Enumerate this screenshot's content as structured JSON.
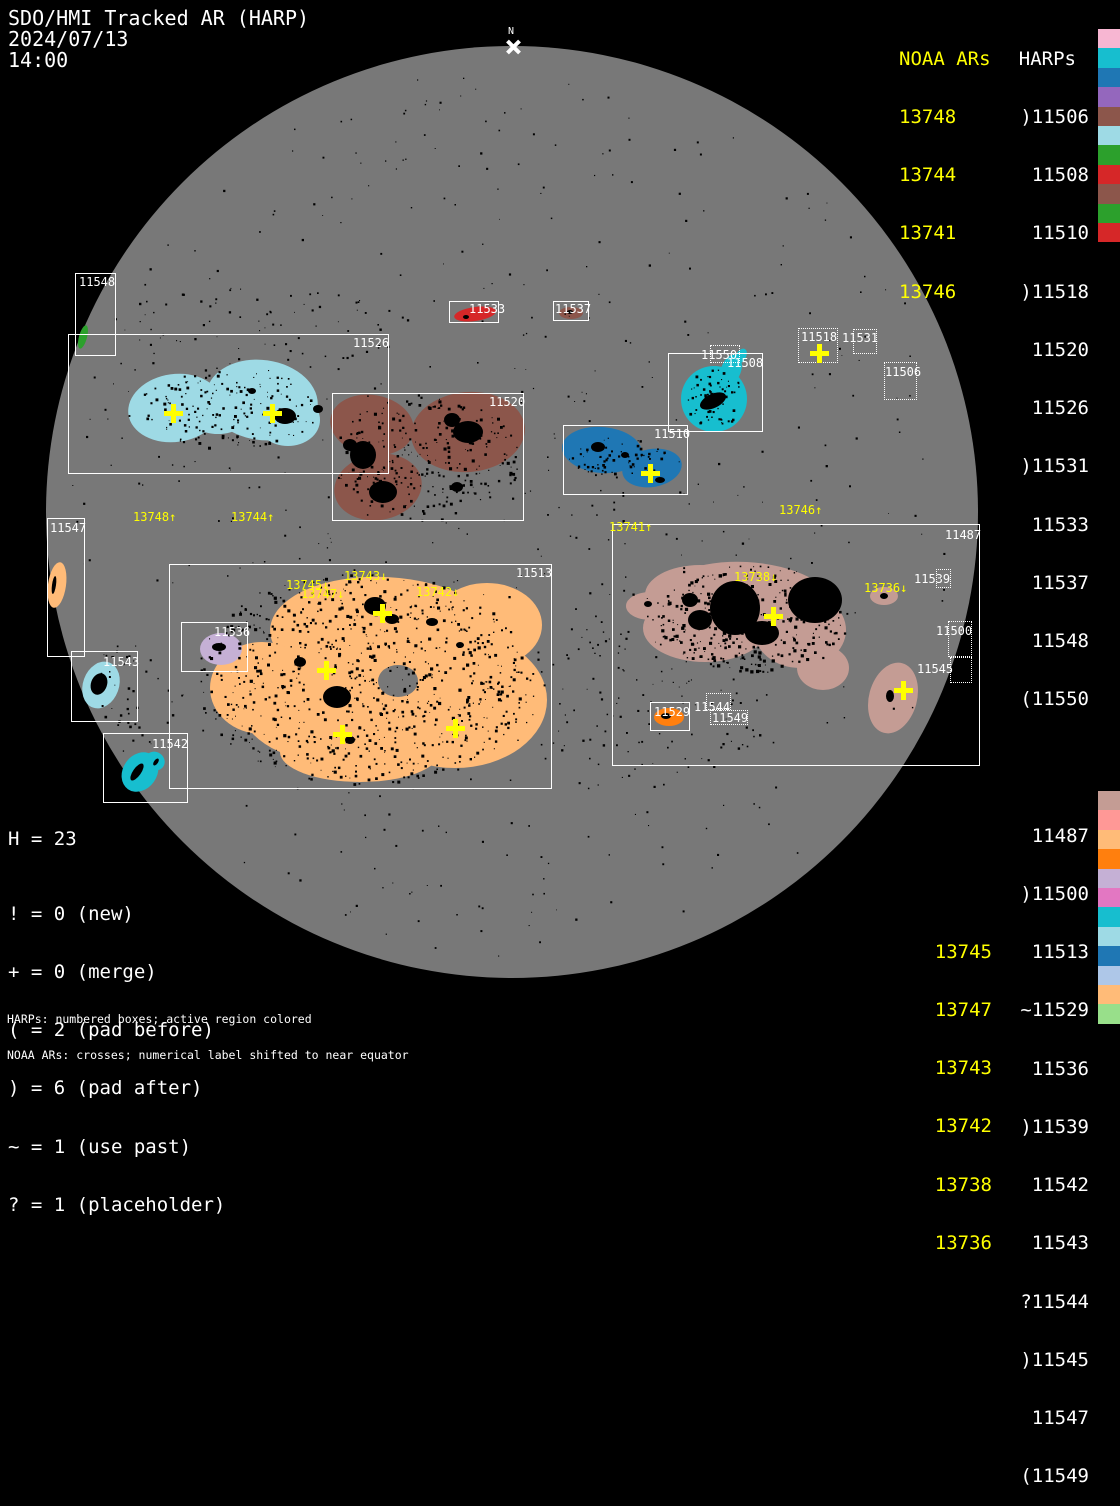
{
  "header": {
    "title": "SDO/HMI Tracked AR (HARP)",
    "date": "2024/07/13",
    "time": "14:00"
  },
  "north_label": "N",
  "colors": {
    "disk_gray": "#787878",
    "yellow": "#ffff00",
    "spot_black": "#000000"
  },
  "harp_colors": {
    "11487": "#c49c94",
    "11500": "#ff9896",
    "11506": "#f7b6d2",
    "11508": "#17becf",
    "11510": "#1f77b4",
    "11513": "#ffbb78",
    "11518": "#9467bd",
    "11520": "#8c564b",
    "11526": "#9edae5",
    "11529": "#ff7f0e",
    "11531": "#2ca02c",
    "11533": "#d62728",
    "11536": "#c5b0d5",
    "11537": "#8c564b",
    "11539": "#e377c2",
    "11542": "#17becf",
    "11543": "#9edae5",
    "11544": "#1f77b4",
    "11545": "#aec7e8",
    "11547": "#ffbb78",
    "11548": "#2ca02c",
    "11549": "#98df8a",
    "11550": "#d62728"
  },
  "legend_top_right": {
    "noaa_title": "NOAA ARs",
    "harps_title": "HARPs",
    "noaa": [
      "13748",
      "13744",
      "13741",
      "13746"
    ],
    "harps": [
      ")11506",
      "11508",
      "11510",
      ")11518",
      "11520",
      "11526",
      ")11531",
      "11533",
      "11537",
      "11548",
      "(11550"
    ]
  },
  "legend_bottom_right": {
    "noaa": [
      "13745",
      "13747",
      "13743",
      "13742",
      "13738",
      "13736"
    ],
    "harps": [
      "11487",
      ")11500",
      "11513",
      "~11529",
      "11536",
      ")11539",
      "11542",
      "11543",
      "?11544",
      ")11545",
      "11547",
      "(11549"
    ]
  },
  "stats": {
    "h": "H = 23",
    "l1": "! = 0 (new)",
    "l2": "+ = 0 (merge)",
    "l3": "( = 2 (pad before)",
    "l4": ") = 6 (pad after)",
    "l5": "~ = 1 (use past)",
    "l6": "? = 1 (placeholder)"
  },
  "footnote1": "HARPs: numbered boxes; active region colored",
  "footnote2": "NOAA ARs: crosses; numerical label shifted to near equator",
  "box_labels": {
    "b11548": "11548",
    "b11526": "11526",
    "b11533": "11533",
    "b11537": "11537",
    "b11520": "11520",
    "b11510": "11510",
    "b11508": "11508",
    "b11550": "11550",
    "b11518": "11518",
    "b11531": "11531",
    "b11506": "11506",
    "b11547": "11547",
    "b11543": "11543",
    "b11542": "11542",
    "b11513": "11513",
    "b11536": "11536",
    "b11529": "11529",
    "b11544": "11544",
    "b11549": "11549",
    "b11487": "11487",
    "b11539": "11539",
    "b11500": "11500",
    "b11545": "11545"
  },
  "ar_labels": {
    "a13748": "13748↑",
    "a13744": "13744↑",
    "a13741": "13741↑",
    "a13746": "13746↑",
    "a13745": "13745↓",
    "a13747": "13747↓",
    "a13743": "13743↓",
    "a13742": "13742↓",
    "a13738": "13738↓",
    "a13736": "13736↓"
  },
  "chart_data": {
    "type": "scatter",
    "title": "SDO/HMI Tracked AR (HARP)",
    "datetime": "2024/07/13 14:00",
    "harp_count": 23,
    "status_counts": {
      "new": 0,
      "merge": 0,
      "pad_before": 2,
      "pad_after": 6,
      "use_past": 1,
      "placeholder": 1
    },
    "harps": [
      {
        "id": 11487,
        "prefix": "",
        "color": "#c49c94",
        "box_px": [
          612,
          524,
          368,
          242
        ]
      },
      {
        "id": 11500,
        "prefix": ")",
        "color": "#ff9896",
        "box_px": [
          948,
          621,
          24,
          36
        ]
      },
      {
        "id": 11506,
        "prefix": ")",
        "color": "#f7b6d2",
        "box_px": [
          884,
          362,
          33,
          38
        ]
      },
      {
        "id": 11508,
        "prefix": "",
        "color": "#17becf",
        "box_px": [
          668,
          353,
          95,
          79
        ]
      },
      {
        "id": 11510,
        "prefix": "",
        "color": "#1f77b4",
        "box_px": [
          563,
          425,
          125,
          70
        ]
      },
      {
        "id": 11513,
        "prefix": "",
        "color": "#ffbb78",
        "box_px": [
          169,
          564,
          383,
          225
        ]
      },
      {
        "id": 11518,
        "prefix": ")",
        "color": "#9467bd",
        "box_px": [
          798,
          328,
          40,
          35
        ]
      },
      {
        "id": 11520,
        "prefix": "",
        "color": "#8c564b",
        "box_px": [
          332,
          393,
          192,
          128
        ]
      },
      {
        "id": 11526,
        "prefix": "",
        "color": "#9edae5",
        "box_px": [
          68,
          334,
          321,
          140
        ]
      },
      {
        "id": 11529,
        "prefix": "~",
        "color": "#ff7f0e",
        "box_px": [
          650,
          702,
          40,
          29
        ]
      },
      {
        "id": 11531,
        "prefix": ")",
        "color": "#2ca02c",
        "box_px": [
          853,
          329,
          24,
          25
        ]
      },
      {
        "id": 11533,
        "prefix": "",
        "color": "#d62728",
        "box_px": [
          449,
          301,
          50,
          22
        ]
      },
      {
        "id": 11536,
        "prefix": "",
        "color": "#c5b0d5",
        "box_px": [
          181,
          622,
          67,
          50
        ]
      },
      {
        "id": 11537,
        "prefix": "",
        "color": "#8c564b",
        "box_px": [
          553,
          301,
          36,
          20
        ]
      },
      {
        "id": 11539,
        "prefix": ")",
        "color": "#e377c2",
        "box_px": [
          936,
          569,
          15,
          19
        ]
      },
      {
        "id": 11542,
        "prefix": "",
        "color": "#17becf",
        "box_px": [
          103,
          733,
          85,
          70
        ]
      },
      {
        "id": 11543,
        "prefix": "",
        "color": "#9edae5",
        "box_px": [
          71,
          651,
          67,
          71
        ]
      },
      {
        "id": 11544,
        "prefix": "?",
        "color": "#1f77b4",
        "box_px": [
          706,
          693,
          25,
          17
        ]
      },
      {
        "id": 11545,
        "prefix": ")",
        "color": "#aec7e8",
        "box_px": [
          950,
          657,
          22,
          26
        ]
      },
      {
        "id": 11547,
        "prefix": "",
        "color": "#ffbb78",
        "box_px": [
          47,
          518,
          38,
          139
        ]
      },
      {
        "id": 11548,
        "prefix": "",
        "color": "#2ca02c",
        "box_px": [
          75,
          273,
          41,
          83
        ]
      },
      {
        "id": 11549,
        "prefix": "(",
        "color": "#98df8a",
        "box_px": [
          710,
          710,
          38,
          15
        ]
      },
      {
        "id": 11550,
        "prefix": "(",
        "color": "#d62728",
        "box_px": [
          710,
          345,
          30,
          18
        ]
      }
    ],
    "noaa_ars": [
      {
        "id": 13736,
        "arrow": "down",
        "label_px": [
          864,
          582
        ]
      },
      {
        "id": 13738,
        "arrow": "down",
        "label_px": [
          734,
          571
        ]
      },
      {
        "id": 13741,
        "arrow": "up",
        "label_px": [
          609,
          521
        ]
      },
      {
        "id": 13742,
        "arrow": "down",
        "label_px": [
          416,
          586
        ]
      },
      {
        "id": 13743,
        "arrow": "down",
        "label_px": [
          344,
          570
        ]
      },
      {
        "id": 13744,
        "arrow": "up",
        "label_px": [
          231,
          511
        ]
      },
      {
        "id": 13745,
        "arrow": "down",
        "label_px": [
          286,
          579
        ]
      },
      {
        "id": 13746,
        "arrow": "up",
        "label_px": [
          779,
          504
        ]
      },
      {
        "id": 13747,
        "arrow": "down",
        "label_px": [
          301,
          588
        ]
      },
      {
        "id": 13748,
        "arrow": "up",
        "label_px": [
          133,
          511
        ]
      }
    ],
    "cross_positions_px": [
      [
        173,
        413
      ],
      [
        272,
        413
      ],
      [
        650,
        473
      ],
      [
        819,
        353
      ],
      [
        382,
        613
      ],
      [
        326,
        670
      ],
      [
        342,
        734
      ],
      [
        455,
        728
      ],
      [
        773,
        616
      ],
      [
        903,
        690
      ]
    ]
  }
}
